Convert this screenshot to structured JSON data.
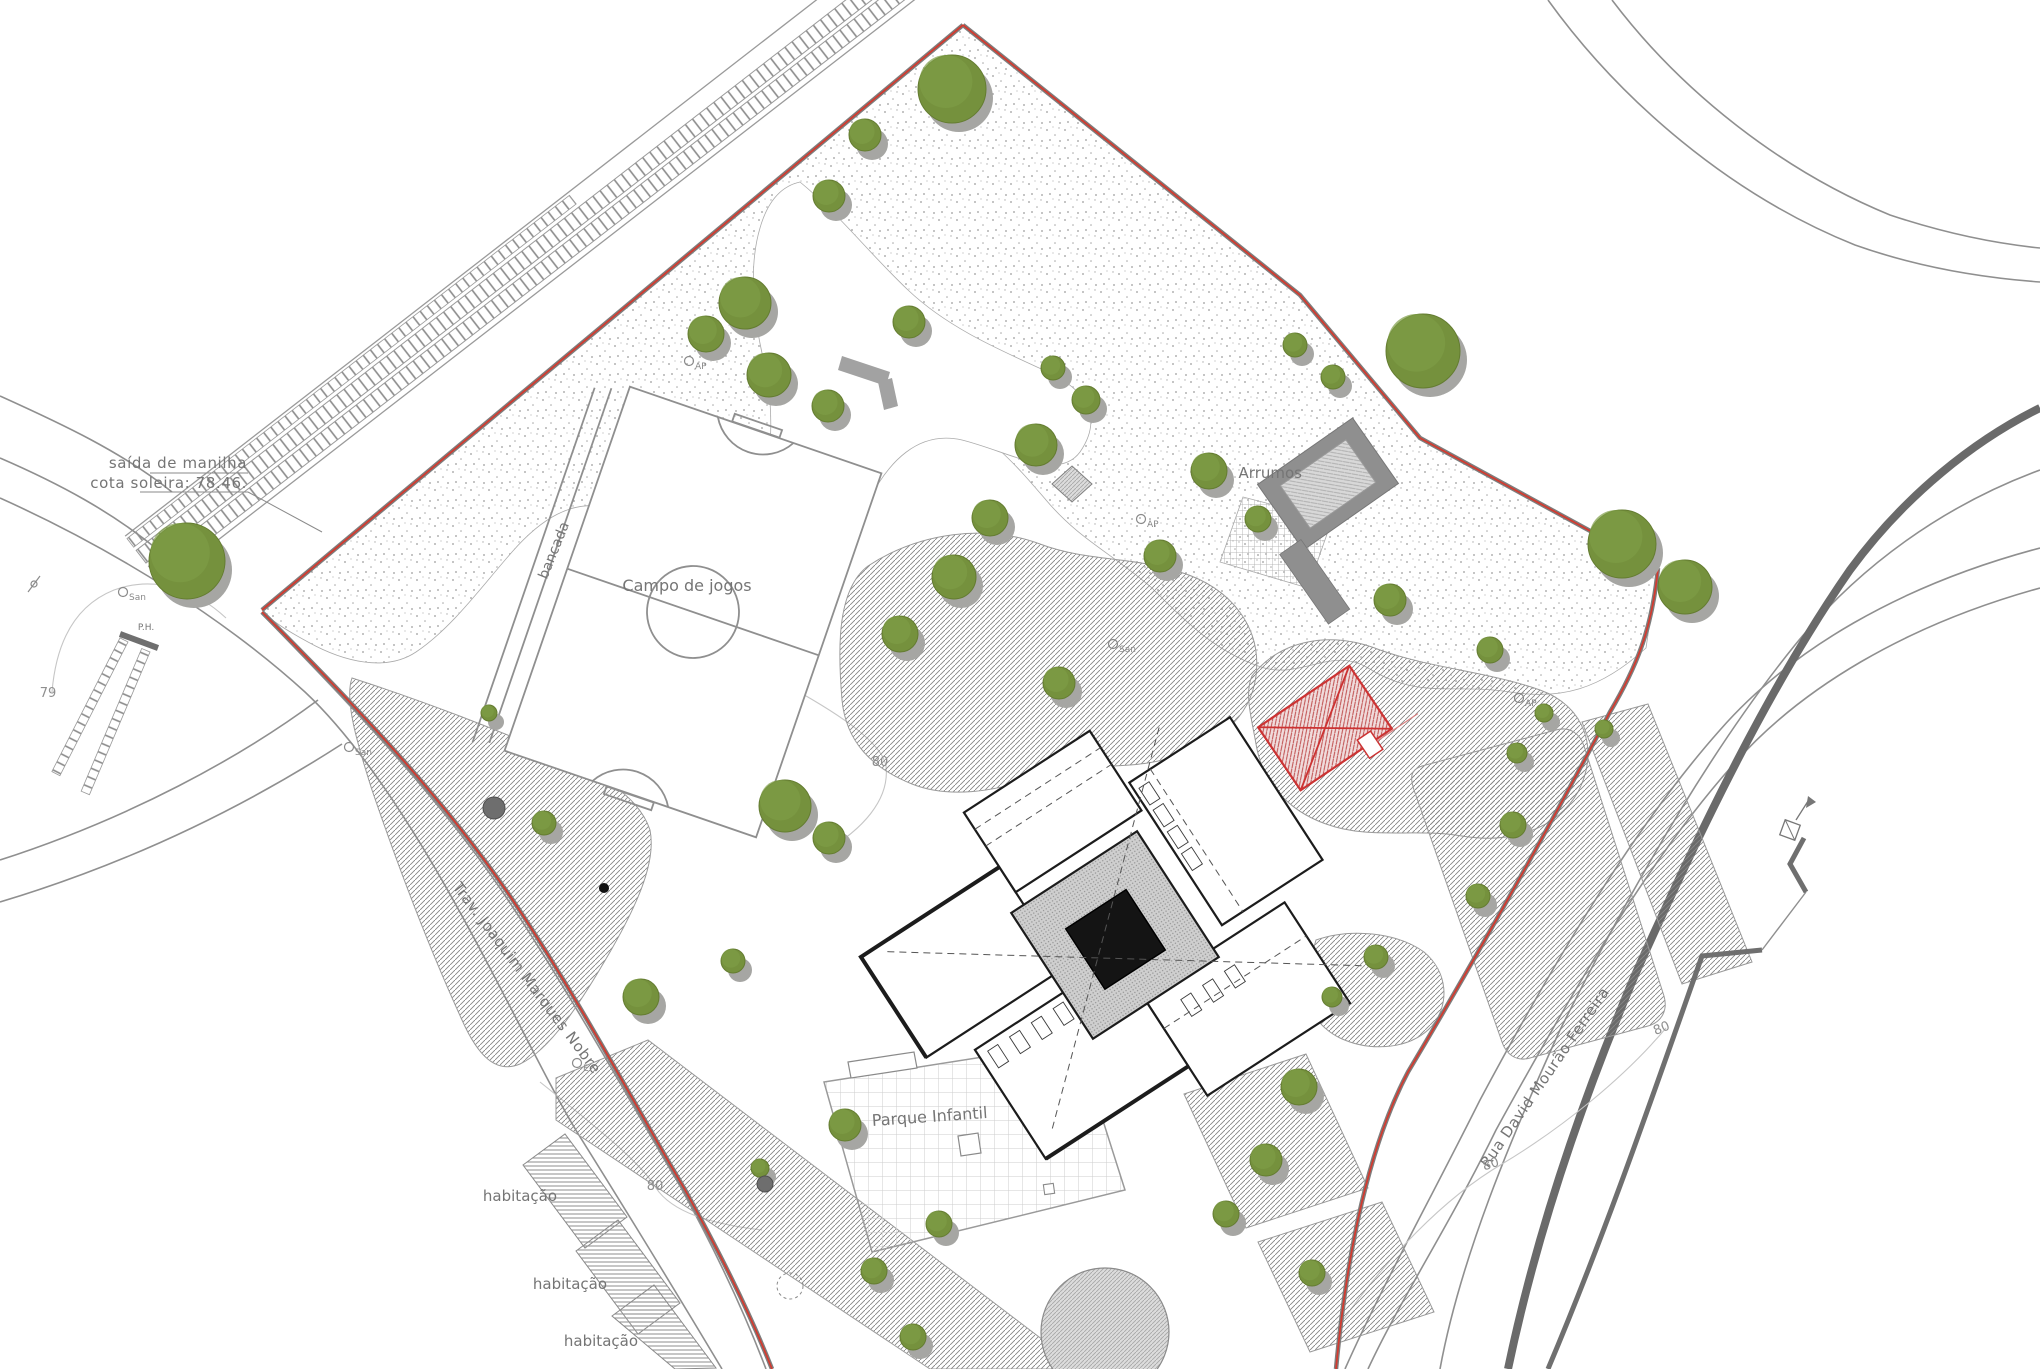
{
  "canvas": {
    "width": 2040,
    "height": 1369,
    "background": "#ffffff"
  },
  "colors": {
    "tree_fill": "#75913d",
    "tree_stroke": "#647c31",
    "tree_highlight": "#7e9c46",
    "tree_shadow": "#a6a6a3",
    "boundary_red": "#d23b30",
    "boundary_grey": "#7d7d7d",
    "line_grey": "#8f8f8f",
    "kerb_dark": "#6a6a6a",
    "hatch_grey": "#858585",
    "building_line": "#1c1c1c",
    "red_structure": "#cc3333",
    "text_grey": "#757575"
  },
  "annotations": [
    {
      "id": "saida-de-manilha-line1",
      "text": "saída de manilha",
      "x": 247,
      "y": 468,
      "rot": 0,
      "size": 15,
      "anchor": "end"
    },
    {
      "id": "saida-de-manilha-line2",
      "text": "cota soleira: 78.46.",
      "x": 247,
      "y": 488,
      "rot": 0,
      "size": 15,
      "anchor": "end"
    },
    {
      "id": "bancada-label",
      "text": "bancada",
      "x": 558,
      "y": 552,
      "rot": -68,
      "size": 14,
      "anchor": "middle"
    },
    {
      "id": "campo-de-jogos-label",
      "text": "Campo de jogos",
      "x": 687,
      "y": 591,
      "rot": 0,
      "size": 16,
      "anchor": "middle"
    },
    {
      "id": "arrumos-label",
      "text": "Arrumos",
      "x": 1302,
      "y": 478,
      "rot": 0,
      "size": 15,
      "anchor": "end"
    },
    {
      "id": "parque-infantil-label",
      "text": "Parque Infantil",
      "x": 930,
      "y": 1122,
      "rot": -4,
      "size": 16,
      "anchor": "middle"
    },
    {
      "id": "street-trav-label",
      "text": "Trav. Joaquim Marques Nobre",
      "x": 523,
      "y": 981,
      "rot": 53,
      "size": 15,
      "anchor": "middle"
    },
    {
      "id": "street-rua-label",
      "text": "Rua David Mourão Ferreira",
      "x": 1549,
      "y": 1080,
      "rot": -55.5,
      "size": 15,
      "anchor": "middle"
    },
    {
      "id": "habitacao-label-1",
      "text": "habitação",
      "x": 557,
      "y": 1201,
      "rot": 0,
      "size": 15,
      "anchor": "end"
    },
    {
      "id": "habitacao-label-2",
      "text": "habitação",
      "x": 607,
      "y": 1289,
      "rot": 0,
      "size": 15,
      "anchor": "end"
    },
    {
      "id": "habitacao-label-3",
      "text": "habitação",
      "x": 638,
      "y": 1346,
      "rot": 0,
      "size": 15,
      "anchor": "end"
    },
    {
      "id": "ph-label",
      "text": "P.H.",
      "x": 146,
      "y": 630,
      "rot": 0,
      "size": 9,
      "anchor": "middle"
    }
  ],
  "contour_labels": [
    {
      "text": "79",
      "x": 48,
      "y": 697,
      "rot": 0
    },
    {
      "text": "80",
      "x": 880,
      "y": 766,
      "rot": 0
    },
    {
      "text": "80",
      "x": 655,
      "y": 1190,
      "rot": 0
    },
    {
      "text": "80",
      "x": 1492,
      "y": 1168,
      "rot": -18
    },
    {
      "text": "80",
      "x": 1663,
      "y": 1032,
      "rot": -22
    }
  ],
  "utility_markers": [
    {
      "symbol": "San",
      "x": 123,
      "y": 592
    },
    {
      "symbol": "San",
      "x": 349,
      "y": 747
    },
    {
      "symbol": "San",
      "x": 1113,
      "y": 644
    },
    {
      "symbol": "AP",
      "x": 689,
      "y": 361
    },
    {
      "symbol": "AP",
      "x": 1141,
      "y": 519
    },
    {
      "symbol": "AP",
      "x": 1519,
      "y": 698
    },
    {
      "symbol": "E",
      "x": 577,
      "y": 1063
    }
  ],
  "trees": [
    [
      952,
      89,
      34
    ],
    [
      865,
      135,
      16
    ],
    [
      829,
      196,
      16
    ],
    [
      909,
      322,
      16
    ],
    [
      745,
      303,
      26
    ],
    [
      706,
      334,
      18
    ],
    [
      769,
      375,
      22
    ],
    [
      828,
      406,
      16
    ],
    [
      1053,
      368,
      12
    ],
    [
      1086,
      400,
      14
    ],
    [
      1423,
      351,
      37
    ],
    [
      1295,
      345,
      12
    ],
    [
      1333,
      377,
      12
    ],
    [
      1036,
      445,
      21
    ],
    [
      990,
      518,
      18
    ],
    [
      1209,
      471,
      18
    ],
    [
      1258,
      519,
      13
    ],
    [
      1622,
      544,
      34
    ],
    [
      1685,
      587,
      27
    ],
    [
      954,
      577,
      22
    ],
    [
      900,
      634,
      18
    ],
    [
      1160,
      556,
      16
    ],
    [
      1390,
      600,
      16
    ],
    [
      1490,
      650,
      13
    ],
    [
      1544,
      713,
      9
    ],
    [
      1604,
      729,
      9
    ],
    [
      1059,
      683,
      16
    ],
    [
      785,
      806,
      26
    ],
    [
      829,
      838,
      16
    ],
    [
      544,
      823,
      12
    ],
    [
      733,
      961,
      12
    ],
    [
      641,
      997,
      18
    ],
    [
      1517,
      753,
      10
    ],
    [
      1513,
      825,
      13
    ],
    [
      1478,
      896,
      12
    ],
    [
      1376,
      957,
      12
    ],
    [
      1332,
      997,
      10
    ],
    [
      1299,
      1087,
      18
    ],
    [
      1266,
      1160,
      16
    ],
    [
      1226,
      1214,
      13
    ],
    [
      1312,
      1273,
      13
    ],
    [
      845,
      1125,
      16
    ],
    [
      939,
      1224,
      13
    ],
    [
      874,
      1271,
      13
    ],
    [
      913,
      1337,
      13
    ],
    [
      760,
      1168,
      9
    ],
    [
      187,
      561,
      38
    ],
    [
      489,
      713,
      8
    ]
  ],
  "shrubs": [
    {
      "x": 494,
      "y": 808,
      "r": 11,
      "kind": "dark"
    },
    {
      "x": 765,
      "y": 1184,
      "r": 8,
      "kind": "dark"
    },
    {
      "x": 604,
      "y": 888,
      "r": 5,
      "kind": "dot"
    },
    {
      "x": 790,
      "y": 1286,
      "r": 13,
      "kind": "dashed"
    }
  ]
}
